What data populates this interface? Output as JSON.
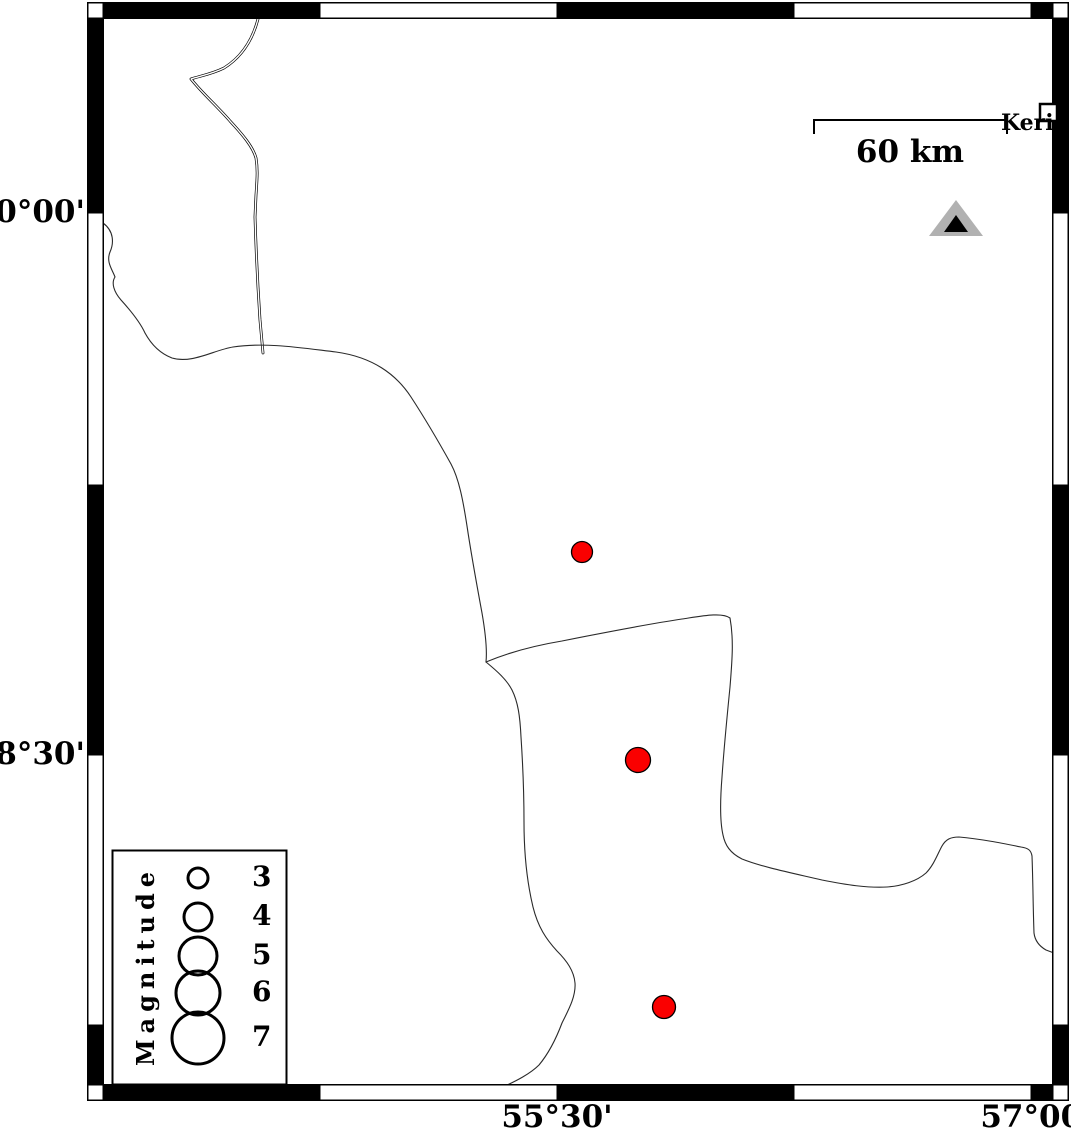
{
  "map": {
    "axis": {
      "left_labels": [
        {
          "text": "30°00'",
          "y_px": 213
        },
        {
          "text": "28°30'",
          "y_px": 755
        }
      ],
      "bottom_labels": [
        {
          "text": "55°30'",
          "x_px": 557
        },
        {
          "text": "57°00'",
          "x_px": 1036
        }
      ]
    },
    "scalebar": {
      "label": "60 km"
    },
    "city": {
      "label": "Keri",
      "marker": "white-square"
    },
    "station": {
      "marker": "gray-black-triangle",
      "approx_lon": 56.76,
      "approx_lat": 29.98
    }
  },
  "legend": {
    "title": "Magnitude",
    "circle_cx_px": 198,
    "entries": [
      {
        "label": "3",
        "r_px": 10,
        "cy_px": 878
      },
      {
        "label": "4",
        "r_px": 14,
        "cy_px": 917
      },
      {
        "label": "5",
        "r_px": 19,
        "cy_px": 956
      },
      {
        "label": "6",
        "r_px": 22,
        "cy_px": 993
      },
      {
        "label": "7",
        "r_px": 26,
        "cy_px": 1038
      }
    ]
  },
  "epicenters": [
    {
      "x": 582,
      "y": 552,
      "r_px": 10.5,
      "approx_magnitude": 3.1,
      "approx_lon": 55.58,
      "approx_lat": 29.06
    },
    {
      "x": 638,
      "y": 760,
      "r_px": 12.5,
      "approx_magnitude": 3.6,
      "approx_lon": 55.76,
      "approx_lat": 28.49
    },
    {
      "x": 664,
      "y": 1007,
      "r_px": 11.5,
      "approx_magnitude": 3.4,
      "approx_lon": 55.84,
      "approx_lat": 27.8
    }
  ],
  "colors": {
    "epicenter": "#fa0000",
    "triangle_gray": "#b1b1b1",
    "frame": "#000000",
    "coastline": "#2a2a2a",
    "background": "#ffffff"
  }
}
